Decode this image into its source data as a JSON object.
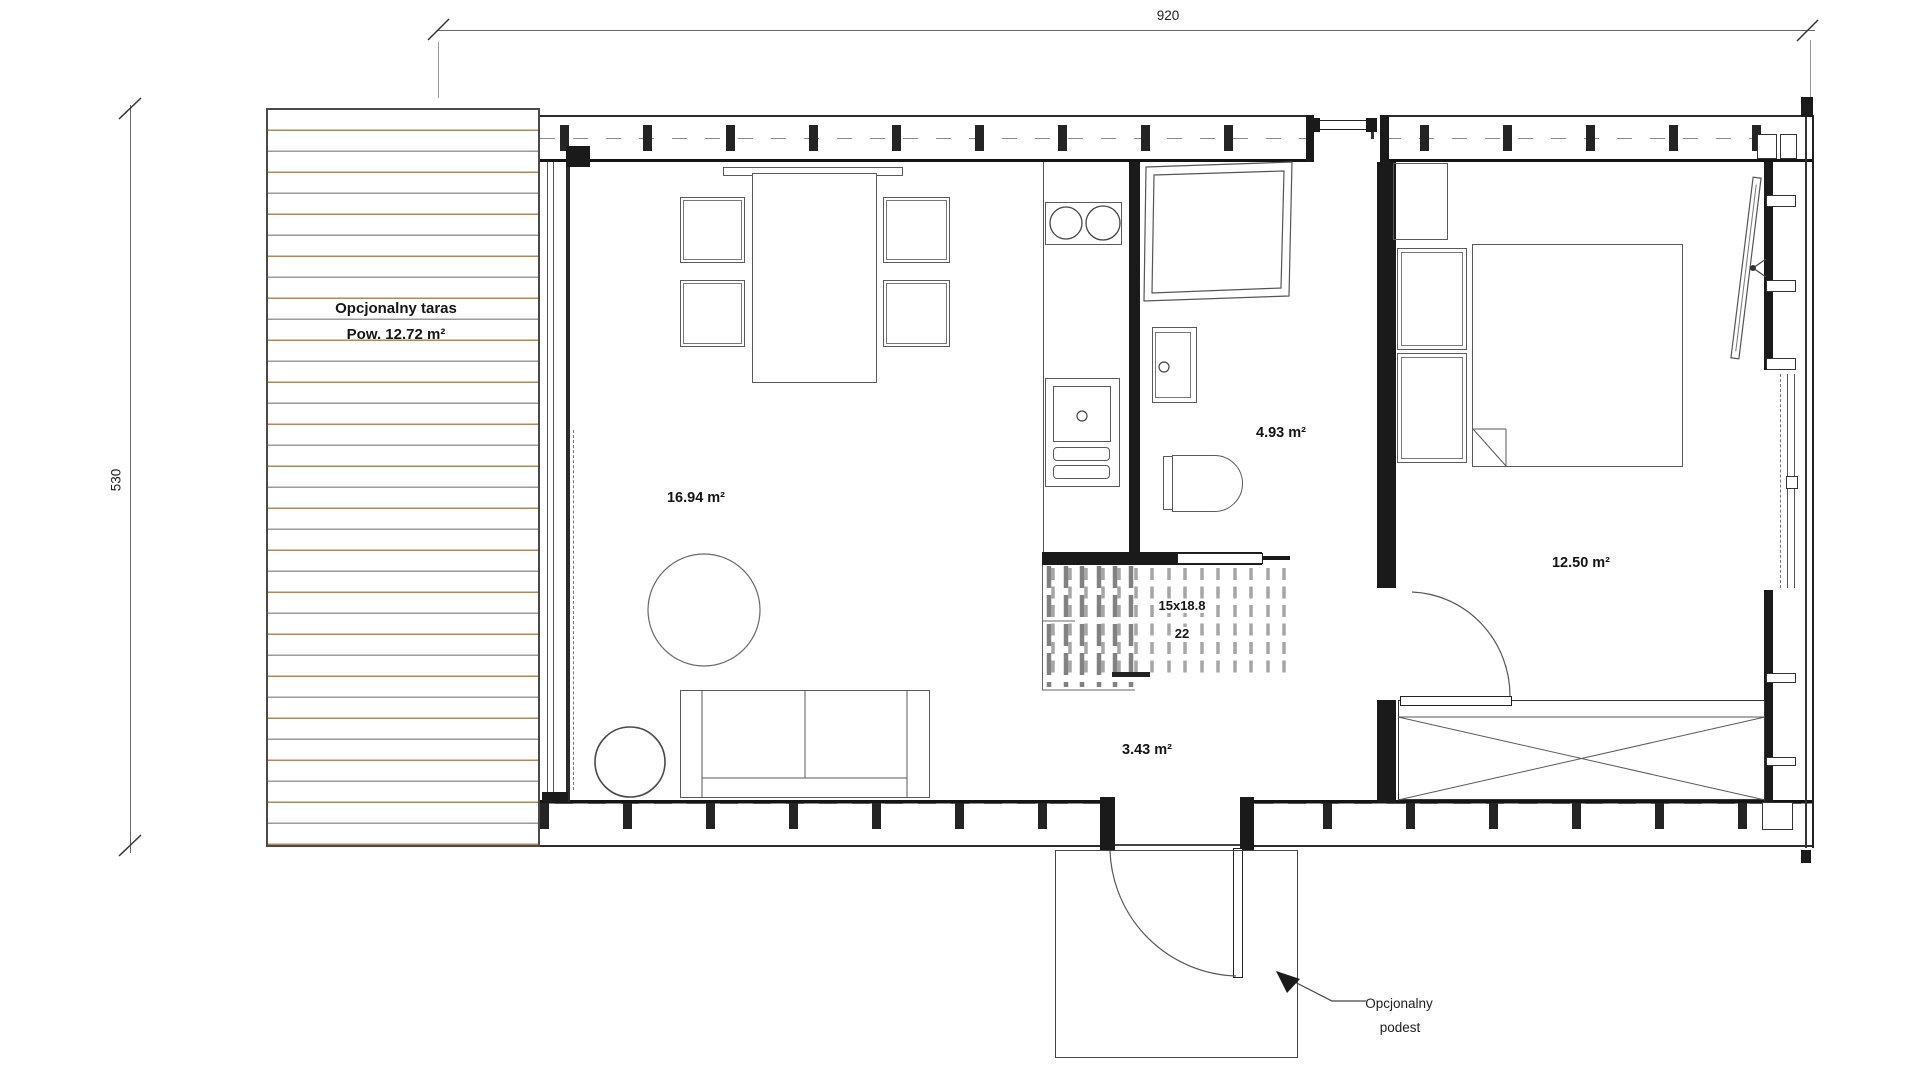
{
  "dimensions": {
    "top": "920",
    "left": "530"
  },
  "terrace": {
    "name": "Opcjonalny taras",
    "area": "Pow. 12.72 m²"
  },
  "rooms": {
    "living": "16.94 m²",
    "bathroom": "4.93 m²",
    "bedroom": "12.50 m²",
    "hallway": "3.43 m²"
  },
  "stairs": {
    "treads": "15x18.8",
    "count": "22"
  },
  "platform": {
    "line1": "Opcjonalny",
    "line2": "podest"
  },
  "colors": {
    "wall": "#1a1a1a",
    "line": "#555555",
    "deck_wood": "#ab8a60",
    "deck_gray": "#9a9a9a",
    "text": "#111111"
  }
}
